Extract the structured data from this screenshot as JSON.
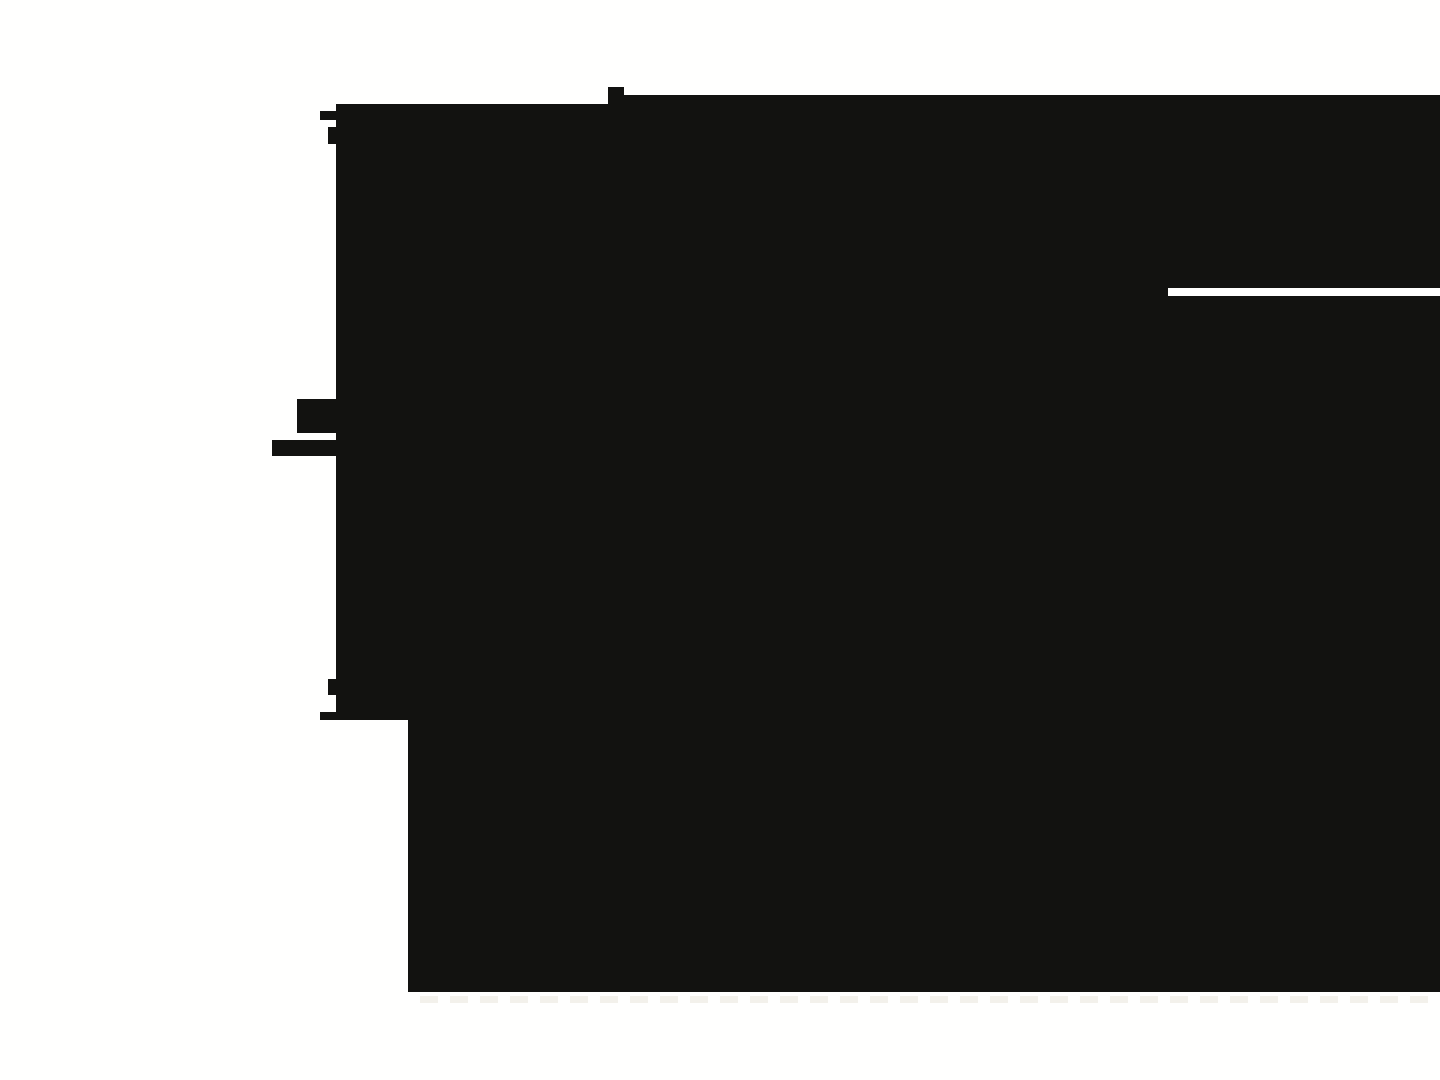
{
  "canvas": {
    "width": 1440,
    "height": 1080,
    "background_color": "#FFFFFE"
  },
  "silhouette": {
    "description": "large irregular black region covering most of the screen",
    "fill_color": "#121210",
    "points": [
      [
        336,
        104
      ],
      [
        608,
        104
      ],
      [
        608,
        87
      ],
      [
        624,
        87
      ],
      [
        624,
        95
      ],
      [
        1440,
        95
      ],
      [
        1440,
        288
      ],
      [
        1168,
        288
      ],
      [
        1168,
        296
      ],
      [
        1440,
        296
      ],
      [
        1440,
        992
      ],
      [
        408,
        992
      ],
      [
        408,
        720
      ],
      [
        320,
        720
      ],
      [
        320,
        712
      ],
      [
        336,
        712
      ],
      [
        336,
        695
      ],
      [
        328,
        695
      ],
      [
        328,
        679
      ],
      [
        336,
        679
      ],
      [
        336,
        456
      ],
      [
        272,
        456
      ],
      [
        272,
        440
      ],
      [
        336,
        440
      ],
      [
        336,
        433
      ],
      [
        297,
        433
      ],
      [
        297,
        399
      ],
      [
        336,
        399
      ],
      [
        336,
        144
      ],
      [
        328,
        144
      ],
      [
        328,
        127
      ],
      [
        336,
        127
      ],
      [
        336,
        120
      ],
      [
        320,
        120
      ],
      [
        320,
        111
      ],
      [
        336,
        111
      ]
    ]
  },
  "right_slot": {
    "description": "thin white slot cut into the black region from the right edge",
    "x": 1168,
    "y": 288,
    "width": 272,
    "height": 8,
    "color": "#FFFFFE"
  },
  "ghost_text_row": {
    "description": "extremely faint text remnants peeking below the bottom edge of the black region",
    "color": "#F3F1EB",
    "y": 996,
    "height": 7,
    "x_start": 420,
    "x_end": 1436,
    "period": 30,
    "dash_width": 18
  }
}
